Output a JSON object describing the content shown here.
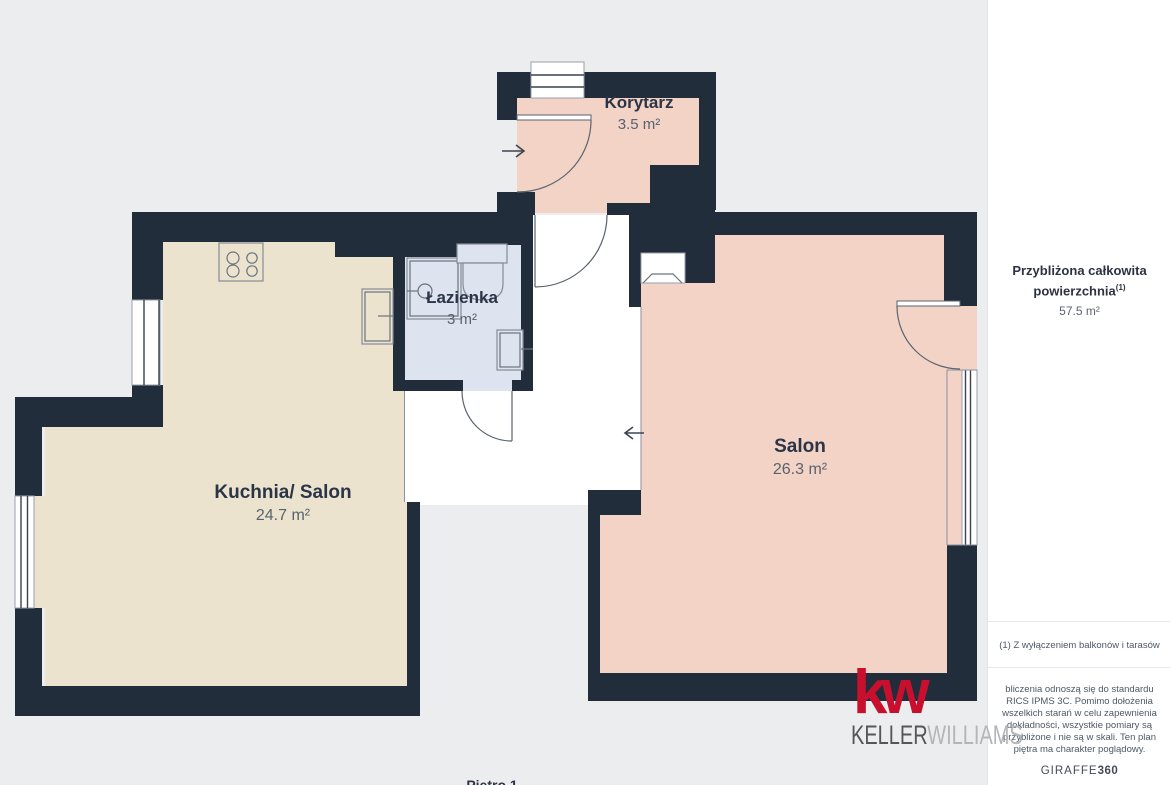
{
  "rooms": [
    {
      "id": "korytarz",
      "name": "Korytarz",
      "area": "3.5 m²"
    },
    {
      "id": "lazienka",
      "name": "Łazienka",
      "area": "3 m²"
    },
    {
      "id": "kuchnia",
      "name": "Kuchnia/ Salon",
      "area": "24.7 m²"
    },
    {
      "id": "salon",
      "name": "Salon",
      "area": "26.3 m²"
    }
  ],
  "floor_label": "Piętro 1",
  "sidebar": {
    "title": "Przybliżona całkowita powierzchnia",
    "title_sup": "(1)",
    "total_area": "57.5 m²",
    "footnote": "(1) Z wyłączeniem balkonów i tarasów",
    "disclaimer": "bliczenia odnoszą się do standardu RICS IPMS 3C. Pomimo dołożenia wszelkich starań w celu zapewnienia dokładności, wszystkie pomiary są przybliżone i nie są w skali. Ten plan piętra ma charakter poglądowy.",
    "brand_giraffe": "GIRAFFE",
    "brand_360": "360"
  },
  "branding": {
    "kw_mark": "kw",
    "keller": "KELLER",
    "williams": "WILLIAMS"
  },
  "colors": {
    "bg": "#ecedee",
    "wall": "#212d3b",
    "pink": "#f2d3c6",
    "cream": "#ebe3cd",
    "blue": "#dde3ef",
    "kwred": "#c8102e"
  }
}
